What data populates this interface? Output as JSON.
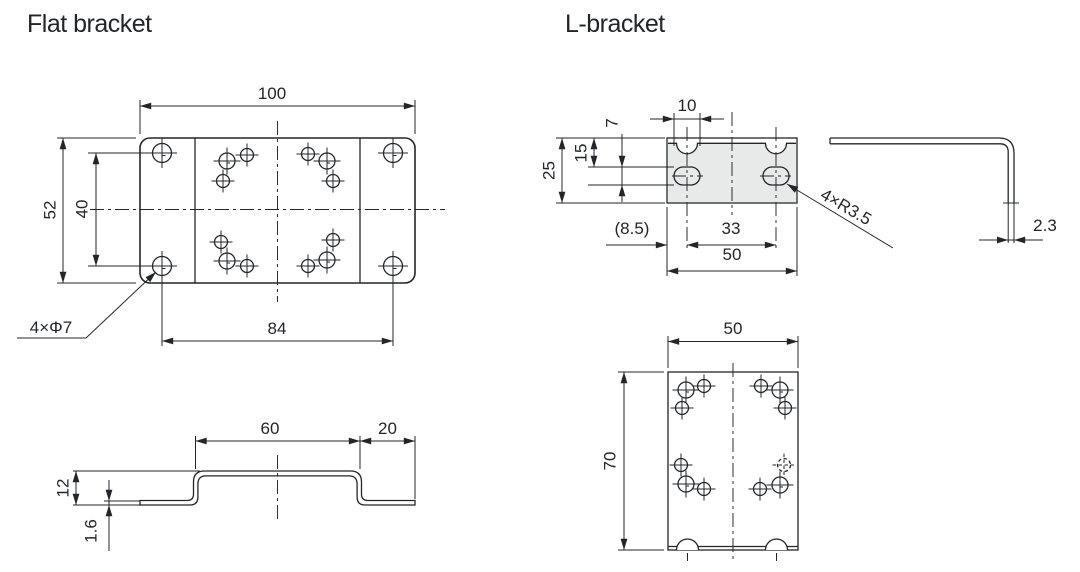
{
  "titles": {
    "flat_bracket": "Flat bracket",
    "l_bracket": "L-bracket"
  },
  "flat_bracket": {
    "top_view": {
      "overall_width": "100",
      "overall_height": "52",
      "hole_spacing_vertical": "40",
      "hole_spacing_horizontal": "84",
      "hole_callout": "4×Φ7"
    },
    "profile_view": {
      "raised_width": "60",
      "flange_width": "20",
      "profile_height": "12",
      "thickness": "1.6"
    }
  },
  "l_bracket": {
    "front_view": {
      "slot_width": "10",
      "slot_height": "7",
      "hole_offset_top": "15",
      "overall_height": "25",
      "edge_offset": "(8.5)",
      "hole_spacing": "33",
      "overall_width": "50",
      "radius_callout": "4×R3.5"
    },
    "side_view": {
      "thickness": "2.3"
    },
    "bottom_view": {
      "overall_width": "50",
      "overall_depth": "70"
    }
  },
  "colors": {
    "line": "#232528",
    "fill": "#e8e9e9",
    "background": "#ffffff"
  }
}
